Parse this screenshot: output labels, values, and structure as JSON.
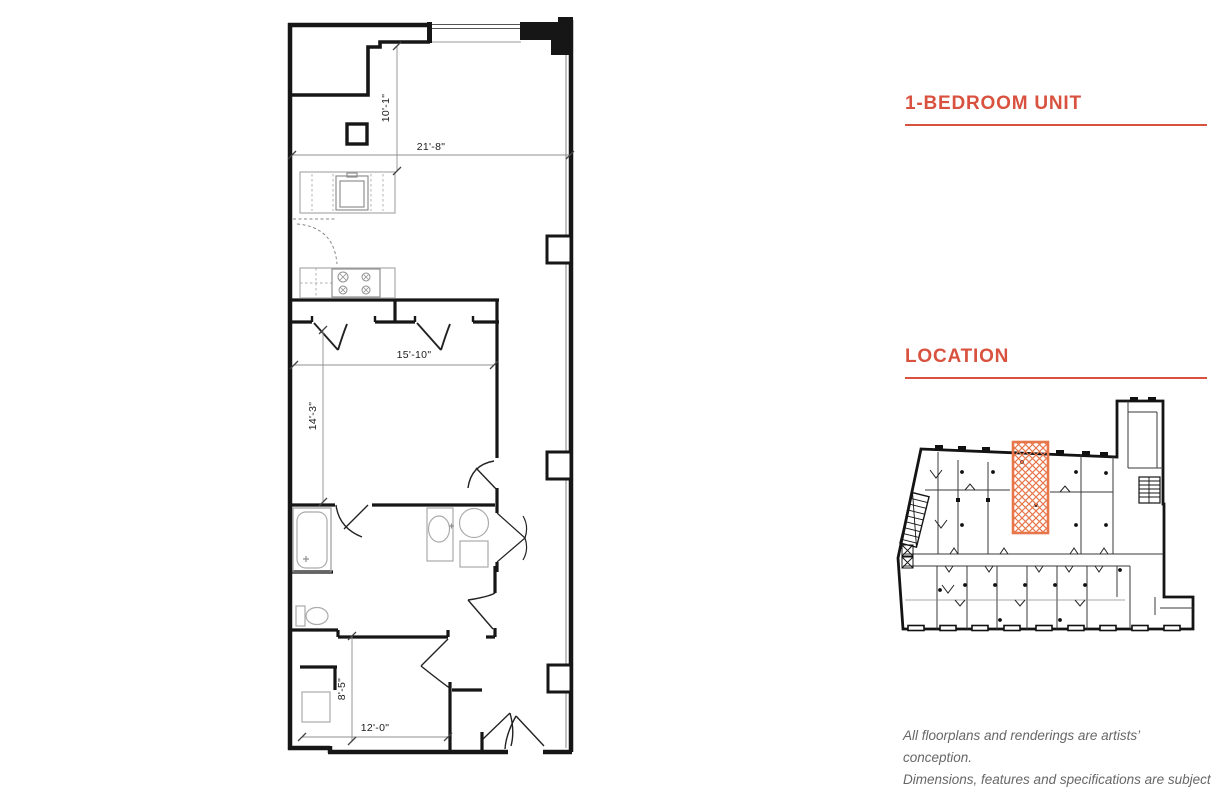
{
  "unit_section": {
    "title": "1-BEDROOM UNIT"
  },
  "location_section": {
    "title": "LOCATION"
  },
  "disclaimer": {
    "line1": "All floorplans and renderings are artists’ conception.",
    "line2": "Dimensions, features and specifications are subject",
    "line3": "to change at the discretion of the builder."
  },
  "floorplan": {
    "dimensions": {
      "living_width": "21'-8\"",
      "living_depth": "10'-1\"",
      "bedroom_width": "15'-10\"",
      "bedroom_depth": "14'-3\"",
      "den_depth": "8'-5\"",
      "den_width": "12'-0\""
    }
  },
  "colors": {
    "accent_red": "#D9523F",
    "highlight_orange": "#E8764B",
    "wall_black": "#161616",
    "fixture_gray": "#A9A9A9",
    "dimension_gray": "#8F8F8F"
  }
}
